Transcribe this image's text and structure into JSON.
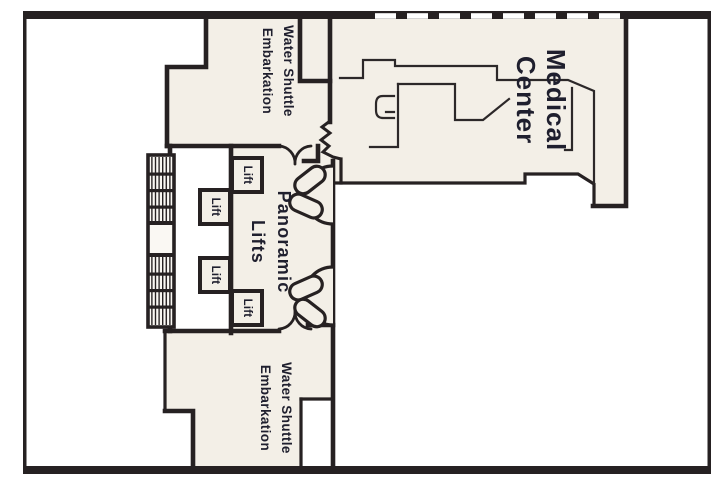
{
  "deck_plan": {
    "colors": {
      "background": "#ffffff",
      "wall": "#262122",
      "room_fill": "#f3efe7",
      "label_text": "#1f1f2e",
      "deck_edge_dash": "#ffffff"
    },
    "labels": {
      "medical_center": {
        "line1": "Medical",
        "line2": "Center"
      },
      "water_shuttle_top": {
        "line1": "Water Shuttle",
        "line2": "Embarkation"
      },
      "water_shuttle_bottom": {
        "line1": "Water Shuttle",
        "line2": "Embarkation"
      },
      "panoramic_lifts": {
        "line1": "Panoramic",
        "line2": "Lifts"
      },
      "lifts": [
        "Lift",
        "Lift",
        "Lift",
        "Lift"
      ]
    }
  }
}
